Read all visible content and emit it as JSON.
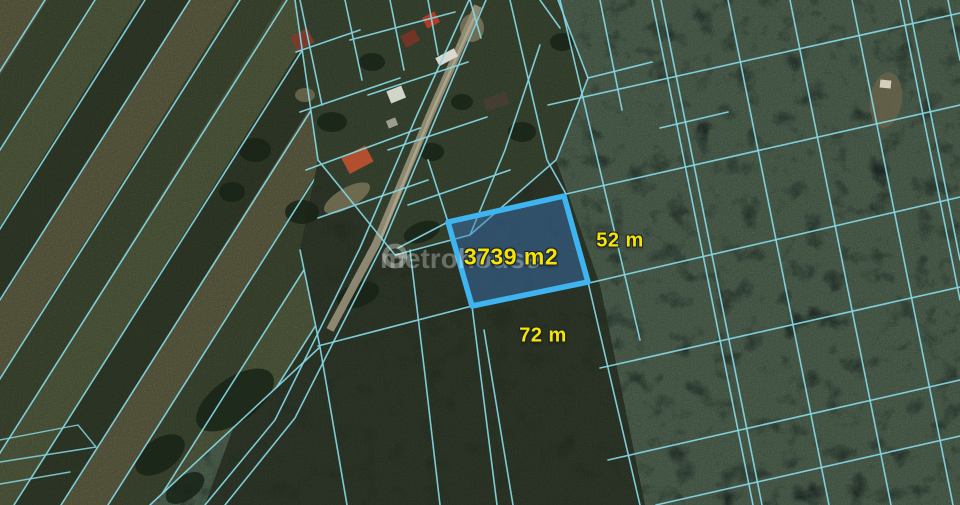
{
  "map": {
    "type": "aerial-cadastral-view",
    "parcel": {
      "area_label": "3739 m2",
      "side_labels": [
        {
          "text": "52 m",
          "side": "right"
        },
        {
          "text": "72 m",
          "side": "bottom"
        }
      ]
    },
    "watermark": {
      "text": "metrohouse",
      "logo": "circle-logo"
    },
    "colors": {
      "boundary-cyan": "#86d8e6",
      "parcel-stroke": "#3eb5f0",
      "parcel-fill": "rgba(58,118,188,0.45)",
      "label-yellow": "#f8e400",
      "forest-dark": "#151f22",
      "farmland-olive": "#5a6647",
      "road-tan": "#98917a"
    }
  }
}
